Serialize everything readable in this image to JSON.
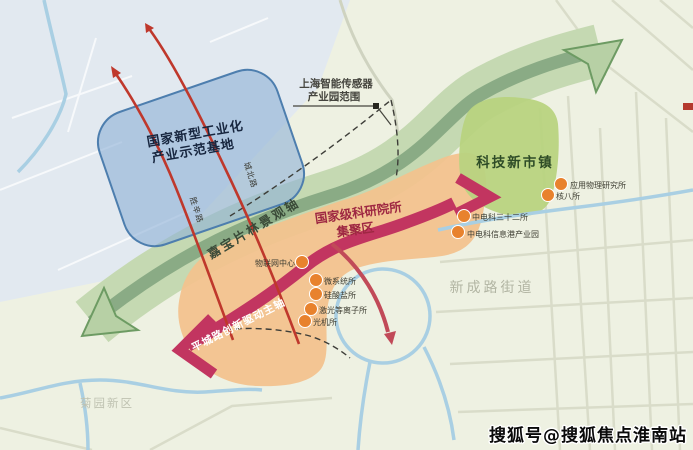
{
  "map": {
    "zones": {
      "industrial_base": {
        "line1": "国家新型工业化",
        "line2": "产业示范基地"
      },
      "sensor_park": {
        "line1": "上海智能传感器",
        "line2": "产业园范围"
      },
      "tech_town": {
        "label": "科技新市镇"
      },
      "research_cluster": {
        "line1": "国家级科研院所",
        "line2": "集聚区"
      }
    },
    "axes": {
      "landscape_axis": {
        "label": "嘉宝片林景观轴"
      },
      "innovation_axis": {
        "label": "平城路创新驱动主轴"
      }
    },
    "roads": {
      "shengxin": "胜辛路",
      "chengbei": "城北路"
    },
    "districts": {
      "xinchenglu": "新成路街道",
      "juyuan": "菊园新区"
    },
    "institutes": [
      {
        "name": "物联网中心"
      },
      {
        "name": "微系统所"
      },
      {
        "name": "硅酸盐所"
      },
      {
        "name": "激光等离子所"
      },
      {
        "name": "光机所"
      },
      {
        "name": "应用物理研究所"
      },
      {
        "name": "核八所"
      },
      {
        "name": "中电科三十二所"
      },
      {
        "name": "中电科信息港产业园"
      }
    ],
    "colors": {
      "corridor_green": "#8aab85",
      "zone_blue": "#8fb2d6",
      "zone_orange": "#f3c28d",
      "zone_green": "#b8d380",
      "axis_pink": "#c23560",
      "arrow_red": "#bf382c",
      "dot_orange": "#e8822d",
      "water_blue": "#a9cfe3"
    }
  },
  "watermark": {
    "text": "搜狐号@搜狐焦点淮南站"
  }
}
